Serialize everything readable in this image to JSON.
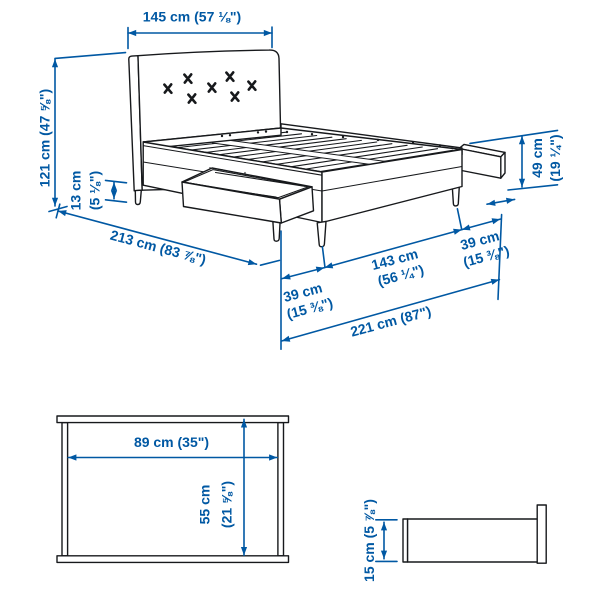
{
  "colors": {
    "dimension_blue": "#0058a3",
    "line_ink": "#17191c",
    "background": "#ffffff"
  },
  "bed": {
    "width_label": "145 cm (57 ⅛\")",
    "height_label": "121 cm (47 ⅝\")",
    "clearance_line1": "13 cm",
    "clearance_line2": "(5 ⅛\")",
    "length_label": "213 cm (83 ⅞\")",
    "segment_left_line1": "39 cm",
    "segment_left_line2": "(15 ⅜\")",
    "segment_middle_line1": "143 cm",
    "segment_middle_line2": "(56 ¼\")",
    "segment_right_line1": "39 cm",
    "segment_right_line2": "(15 ⅜\")",
    "total_length_label": "221 cm (87\")",
    "foot_height_line1": "49 cm",
    "foot_height_line2": "(19 ¼\")"
  },
  "drawer_top_view": {
    "width_label": "89 cm (35\")",
    "depth_line1": "55 cm",
    "depth_line2": "(21 ⅝\")"
  },
  "drawer_side_view": {
    "height_label": "15 cm (5 ⅞\")"
  }
}
